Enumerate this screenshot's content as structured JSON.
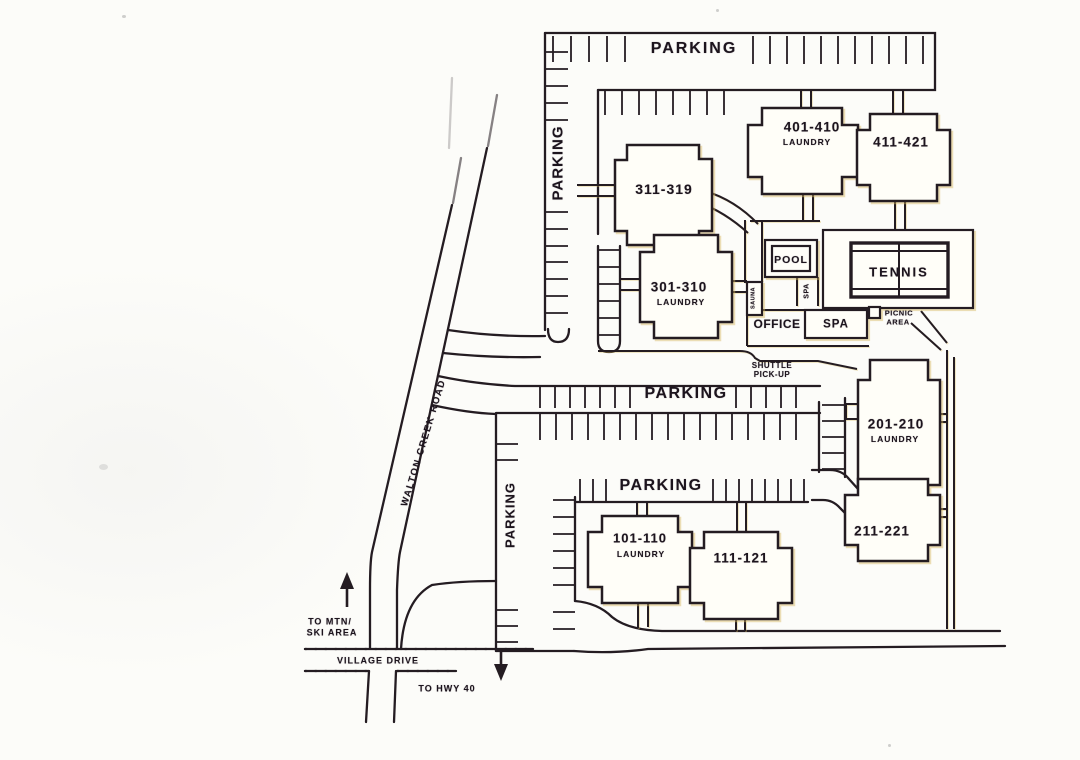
{
  "style": {
    "ink": "#241c22",
    "paper": "#fcfcf9",
    "highlight": "#d8b95f"
  },
  "roads": {
    "walton_creek_road": "WALTON CREEK ROAD",
    "village_drive": "VILLAGE DRIVE",
    "to_hwy_40": "TO HWY 40",
    "to_mtn_line1": "TO MTN/",
    "to_mtn_line2": "SKI AREA"
  },
  "parking": {
    "top": "PARKING",
    "west": "PARKING",
    "middle": "PARKING",
    "south": "PARKING",
    "southwest": "PARKING"
  },
  "buildings": {
    "b101": {
      "label": "101-110",
      "sub": "LAUNDRY"
    },
    "b111": {
      "label": "111-121"
    },
    "b201": {
      "label": "201-210",
      "sub": "LAUNDRY"
    },
    "b211": {
      "label": "211-221"
    },
    "b301": {
      "label": "301-310",
      "sub": "LAUNDRY"
    },
    "b311": {
      "label": "311-319"
    },
    "b401": {
      "label": "401-410",
      "sub": "LAUNDRY"
    },
    "b411": {
      "label": "411-421"
    }
  },
  "amenities": {
    "pool": "POOL",
    "tennis": "TENNIS",
    "spa": "SPA",
    "spa_walk": "SPA",
    "sauna": "SAUNA",
    "office": "OFFICE",
    "picnic_line1": "PICNIC",
    "picnic_line2": "AREA",
    "shuttle_line1": "SHUTTLE",
    "shuttle_line2": "PICK-UP"
  }
}
